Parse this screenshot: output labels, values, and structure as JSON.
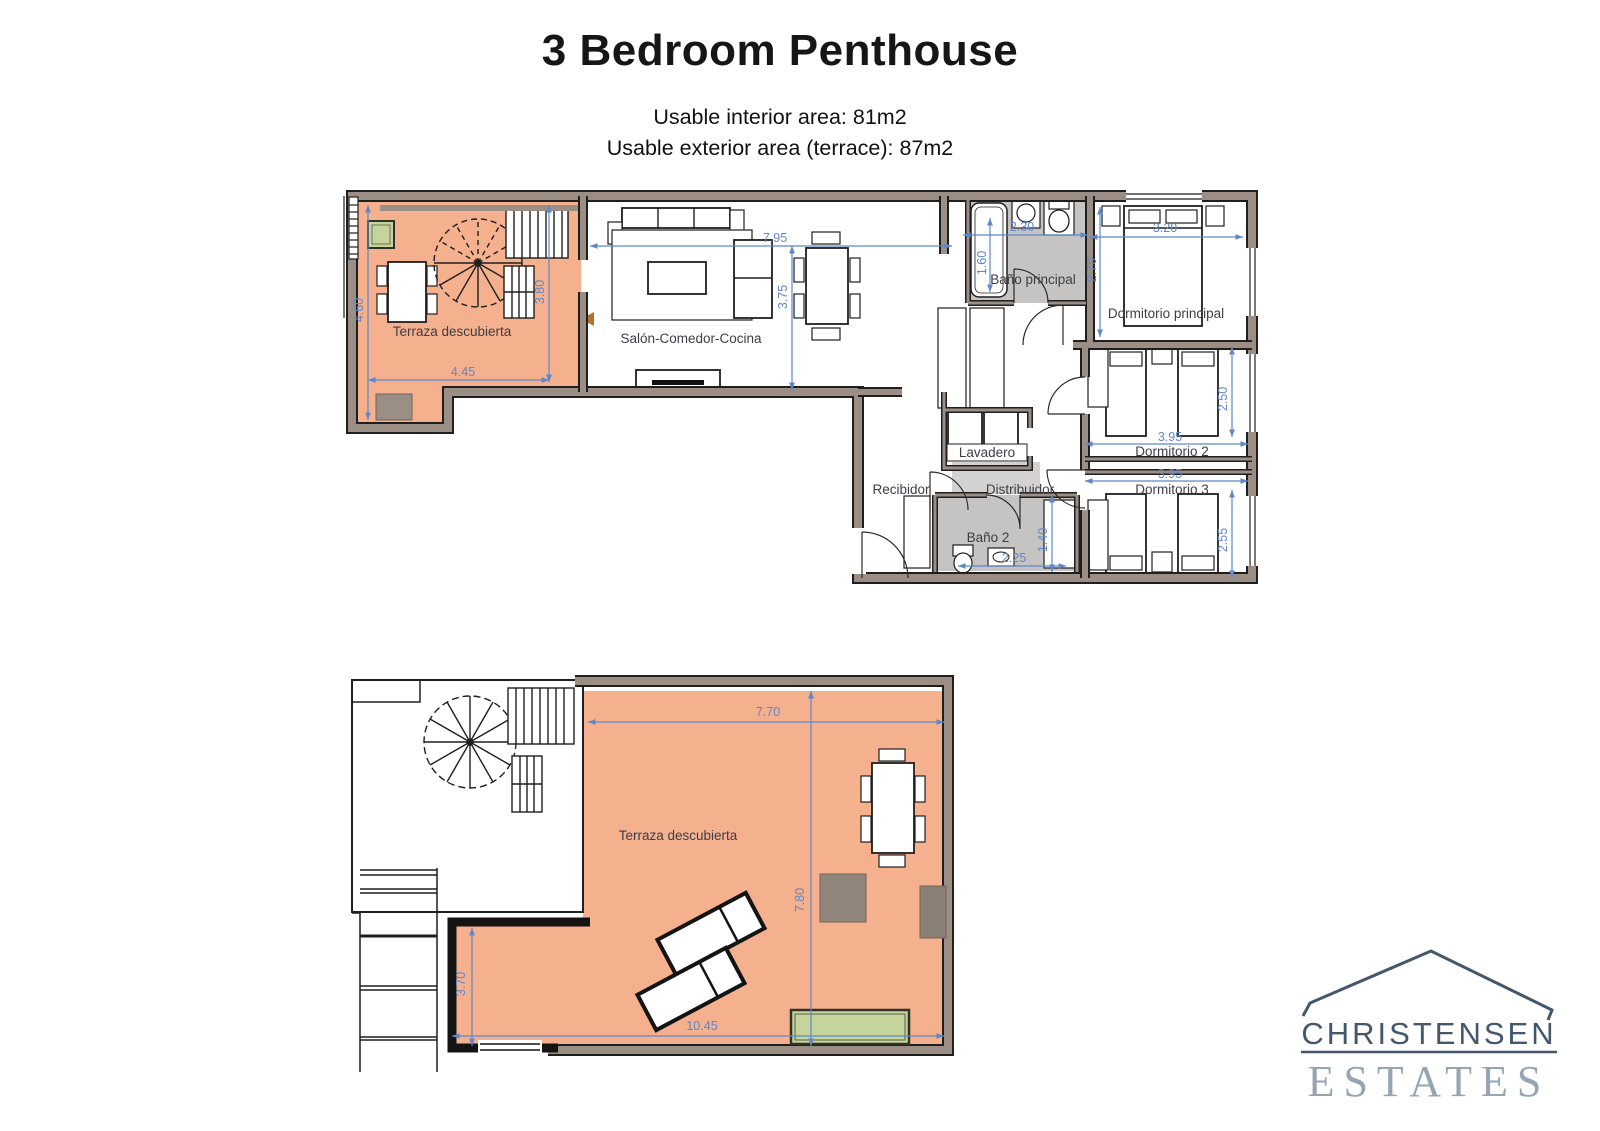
{
  "header": {
    "title": "3 Bedroom Penthouse",
    "line1": "Usable interior area: 81m2",
    "line2": "Usable exterior area (terrace): 87m2"
  },
  "floor1": {
    "labels": {
      "terrace": "Terraza descubierta",
      "living": "Salón-Comedor-Cocina",
      "bath1": "Baño principal",
      "bedroom1": "Dormitorio principal",
      "laundry": "Lavadero",
      "hall": "Recibidor",
      "corridor": "Distribuidor",
      "bedroom2": "Dormitorio 2",
      "bedroom3": "Dormitorio 3",
      "bath2": "Baño 2"
    },
    "dims": {
      "terrace_height": "4.60",
      "terrace_inner_height": "3.80",
      "terrace_width": "4.45",
      "living_width": "7.95",
      "living_height": "3.75",
      "bath1_width": "2.30",
      "bath1_height": "1.60",
      "bedroom1_width": "3.20",
      "bedroom1_height": "2.70",
      "bedroom2_width": "3.95",
      "bedroom2_height": "2.50",
      "bedroom3_width": "3.95",
      "bedroom3_height": "2.55",
      "bath2_width": "2.25",
      "bath2_height": "1.40"
    }
  },
  "floor2": {
    "labels": {
      "terrace": "Terraza descubierta"
    },
    "dims": {
      "top_width": "7.70",
      "right_height": "7.80",
      "left_height": "3.70",
      "bottom_width": "10.45"
    }
  },
  "logo": {
    "name": "CHRISTENSEN",
    "word": "ESTATES"
  },
  "colors": {
    "terrace_fill": "#f5b08e",
    "wall": "#9b8e84",
    "bath_floor": "#c6c4c2",
    "dimension_blue": "#5f87c9",
    "planter_green": "#c5d49a",
    "logo_dark": "#44576b",
    "logo_light": "#96a5b3"
  }
}
